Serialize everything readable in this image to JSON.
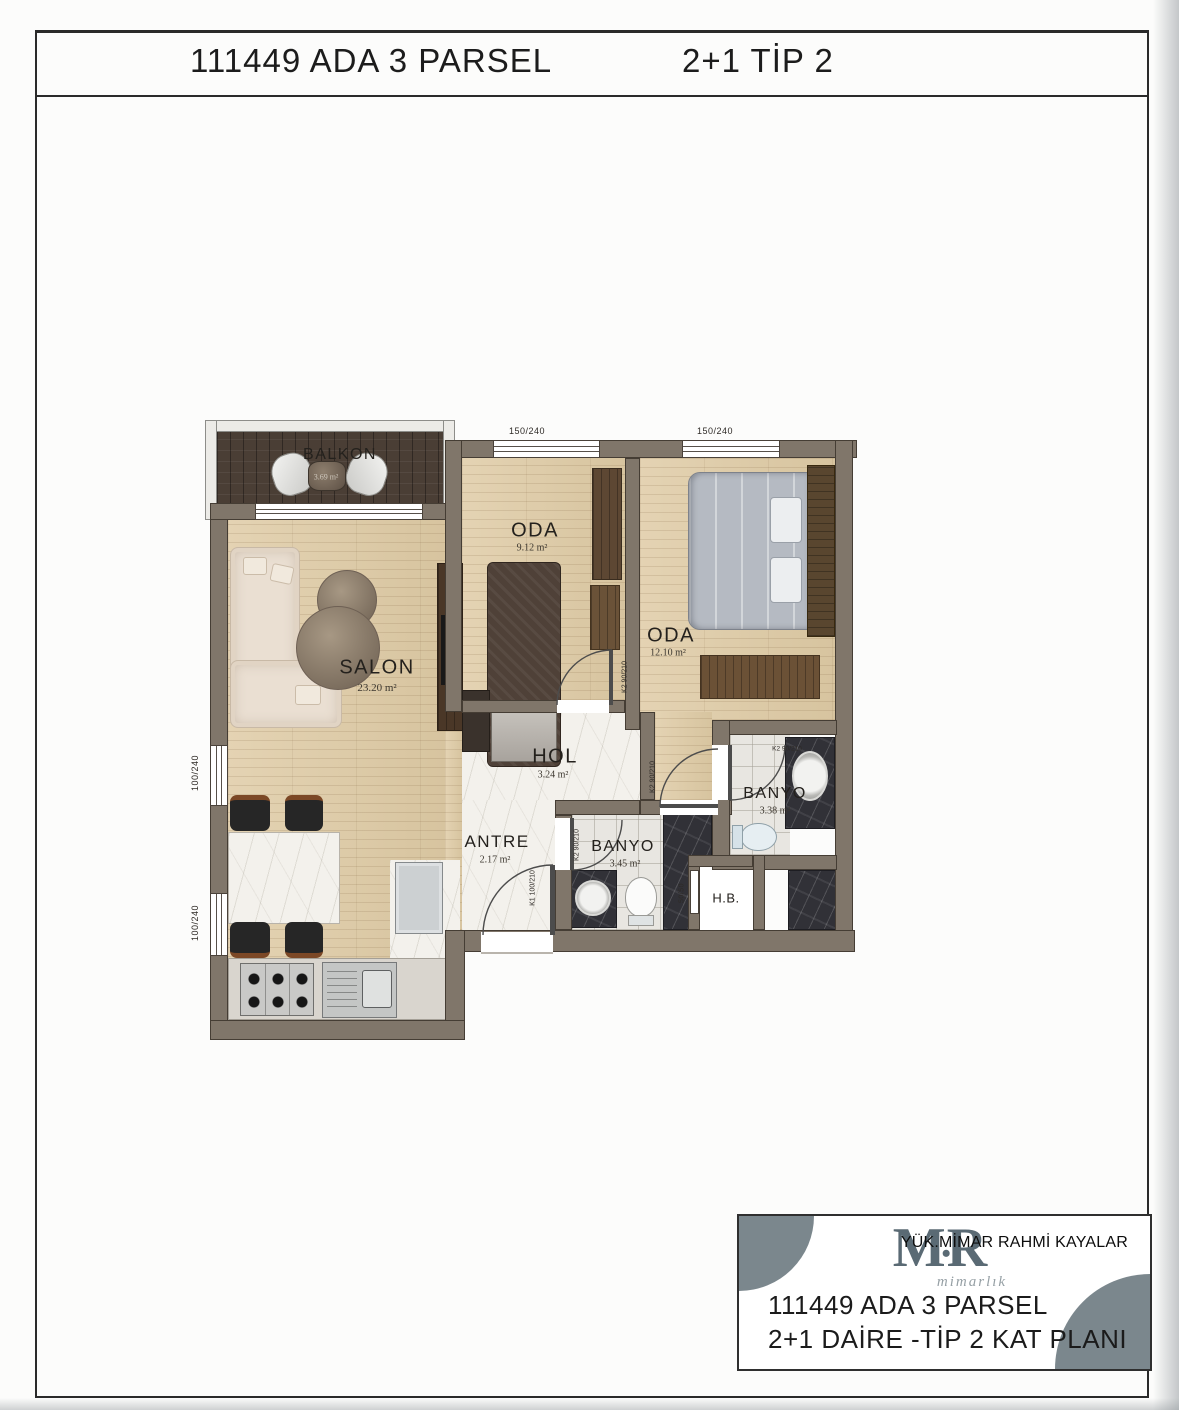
{
  "header": {
    "title_left": "111449 ADA 3 PARSEL",
    "title_right": "2+1 TİP 2"
  },
  "rooms": {
    "balkon": {
      "name": "BALKON",
      "area": "3.69 m²"
    },
    "salon": {
      "name": "SALON",
      "area": "23.20 m²"
    },
    "oda1": {
      "name": "ODA",
      "area": "9.12 m²"
    },
    "oda2": {
      "name": "ODA",
      "area": "12.10 m²"
    },
    "hol": {
      "name": "HOL",
      "area": "3.24 m²"
    },
    "antre": {
      "name": "ANTRE",
      "area": "2.17 m²"
    },
    "banyo1": {
      "name": "BANYO",
      "area": "3.45 m²"
    },
    "banyo2": {
      "name": "BANYO",
      "area": "3.38 m²"
    },
    "hb": {
      "name": "H.B."
    }
  },
  "dimensions": {
    "window_large": "150/240",
    "window_left": "100/240",
    "shaft": "50/50"
  },
  "doors": {
    "k1": "K1 100/210",
    "k2": "K2 90/210"
  },
  "title_block": {
    "architect": "YÜK.MİMAR RAHMİ KAYALAR",
    "logo_m": "M",
    "logo_dot": "•",
    "logo_r": "R",
    "logo_sub": "mimarlık",
    "line1": "111449 ADA 3 PARSEL",
    "line2": "2+1 DAİRE -TİP 2  KAT PLANI"
  },
  "colors": {
    "wall": "#80766a",
    "wood_floor": "#ddcba8",
    "balcony_floor": "#4a3e35",
    "marble": "#f3f1ec",
    "dark_marble": "#313137",
    "logo": "#5a6a74",
    "block_circle": "#7b878d"
  }
}
